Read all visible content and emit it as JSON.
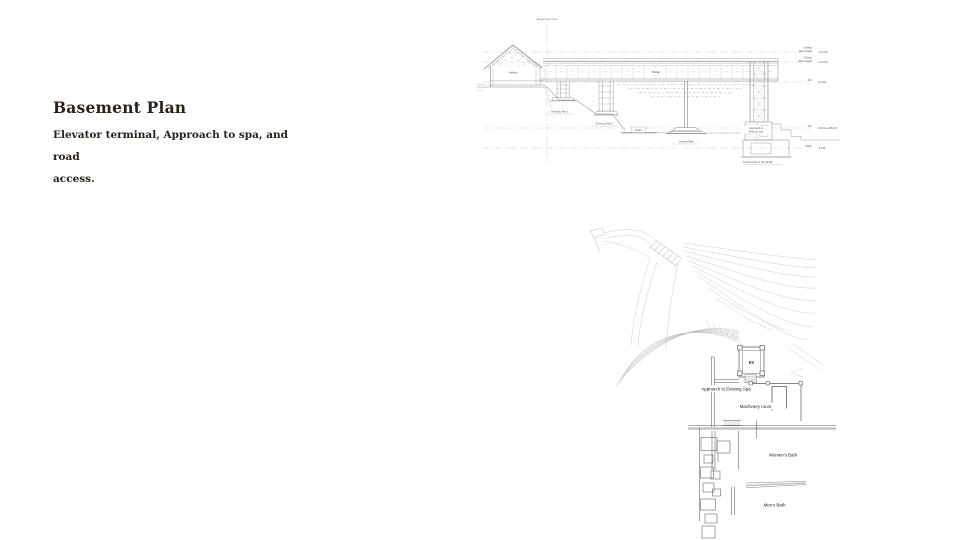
{
  "slide": {
    "title": "Basement Plan",
    "subtitle_line1": "Elevator terminal, Approach to spa, and road",
    "subtitle_line2": "access."
  },
  "section_drawing": {
    "expansion_line": "Expansion Line",
    "gallery": "Gallery",
    "bridge": "Bridge",
    "framing_pier_1": "Framing Pier 1",
    "framing_pier_2": "Framing Pier 2",
    "road": "Road",
    "central_pillar": "Central Pillar",
    "approach_line1": "Approach to",
    "approach_line2": "Existing Spa",
    "framing_pier_3": "Framing Pier 3 (EV Shaft)",
    "levels": {
      "gallery": {
        "line1": "Gallery",
        "line2": "Max Height",
        "value": "+13,700"
      },
      "bridge": {
        "line1": "Bridge",
        "line2": "Max Height",
        "value": "+13,760"
      },
      "fl2": {
        "label": "2FL",
        "value": "+8,460"
      },
      "fl1": {
        "label": "1FL",
        "value": "±0=(GL+258.25)"
      },
      "b1fl": {
        "label": "B1FL",
        "value": "-4,750"
      }
    }
  },
  "plan_drawing": {
    "ev": "EV",
    "approach_spa": "Approach to Existing Spa",
    "machinery_room": "Machinery room",
    "womens_bath": "Women's Bath",
    "mens_bath": "Men's Bath"
  },
  "colors": {
    "title_text": "#2b2118",
    "drawing_line_light": "#b8b8b8",
    "drawing_line_mid": "#8a8a8a",
    "drawing_line_dark": "#555555",
    "label_text": "#1c1c1c"
  }
}
